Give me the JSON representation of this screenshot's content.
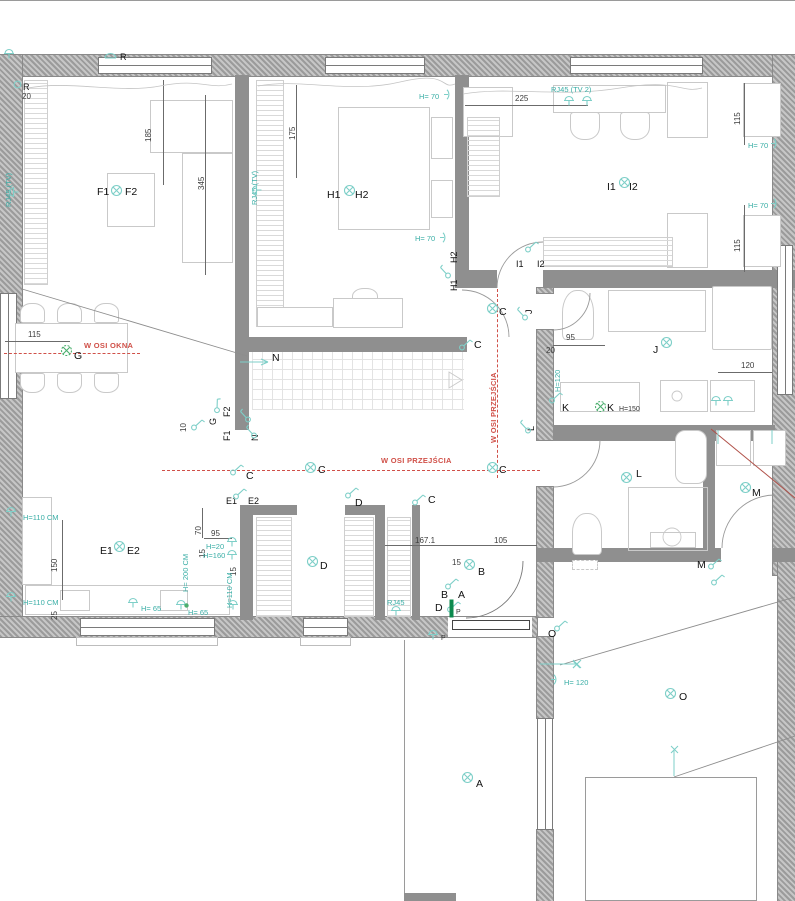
{
  "title": "Floor plan with electrical layout",
  "colors": {
    "teal_text": "#3aaea6",
    "teal_glyph": "#7ecfc8",
    "green": "#4caf6e",
    "red_axis": "#d05048",
    "dim_text": "#3d3d3d",
    "room_label": "#111111",
    "wall_gray": "#9b9b9b"
  },
  "axis_labels": [
    "W OSI OKNA",
    "W OSI PRZEJŚCIA",
    "W OSI PRZEJŚCIA"
  ],
  "texts": [
    {
      "t": "F1",
      "x": 97,
      "y": 186,
      "cls": "room"
    },
    {
      "t": "F2",
      "x": 125,
      "y": 186,
      "cls": "room"
    },
    {
      "t": "H1",
      "x": 327,
      "y": 189,
      "cls": "room"
    },
    {
      "t": "H2",
      "x": 355,
      "y": 189,
      "cls": "room"
    },
    {
      "t": "I1",
      "x": 607,
      "y": 181,
      "cls": "room"
    },
    {
      "t": "I2",
      "x": 629,
      "y": 181,
      "cls": "room"
    },
    {
      "t": "G",
      "x": 74,
      "y": 350,
      "cls": "room"
    },
    {
      "t": "N",
      "x": 272,
      "y": 352,
      "cls": "room"
    },
    {
      "t": "C",
      "x": 499,
      "y": 306,
      "cls": "room"
    },
    {
      "t": "C",
      "x": 474,
      "y": 339,
      "cls": "room"
    },
    {
      "t": "C",
      "x": 318,
      "y": 464,
      "cls": "room"
    },
    {
      "t": "C",
      "x": 499,
      "y": 464,
      "cls": "room"
    },
    {
      "t": "C",
      "x": 246,
      "y": 470,
      "cls": "room"
    },
    {
      "t": "C",
      "x": 428,
      "y": 494,
      "cls": "room"
    },
    {
      "t": "D",
      "x": 355,
      "y": 497,
      "cls": "room"
    },
    {
      "t": "D",
      "x": 320,
      "y": 560,
      "cls": "room"
    },
    {
      "t": "E1",
      "x": 226,
      "y": 496,
      "cls": "rm"
    },
    {
      "t": "E2",
      "x": 248,
      "y": 496,
      "cls": "rm"
    },
    {
      "t": "E1",
      "x": 100,
      "y": 545,
      "cls": "room"
    },
    {
      "t": "E2",
      "x": 127,
      "y": 545,
      "cls": "room"
    },
    {
      "t": "B",
      "x": 478,
      "y": 566,
      "cls": "room"
    },
    {
      "t": "B",
      "x": 441,
      "y": 589,
      "cls": "room"
    },
    {
      "t": "A",
      "x": 458,
      "y": 589,
      "cls": "room"
    },
    {
      "t": "D",
      "x": 435,
      "y": 602,
      "cls": "room"
    },
    {
      "t": "P",
      "x": 456,
      "y": 609,
      "cls": "tiny"
    },
    {
      "t": "P",
      "x": 441,
      "y": 635,
      "cls": "tiny"
    },
    {
      "t": "J",
      "x": 653,
      "y": 344,
      "cls": "room"
    },
    {
      "t": "K",
      "x": 562,
      "y": 402,
      "cls": "room"
    },
    {
      "t": "K",
      "x": 607,
      "y": 402,
      "cls": "room"
    },
    {
      "t": "H=150",
      "x": 619,
      "y": 406,
      "cls": "tiny"
    },
    {
      "t": "L",
      "x": 636,
      "y": 468,
      "cls": "room"
    },
    {
      "t": "M",
      "x": 752,
      "y": 487,
      "cls": "room"
    },
    {
      "t": "M",
      "x": 697,
      "y": 559,
      "cls": "room"
    },
    {
      "t": "O",
      "x": 679,
      "y": 691,
      "cls": "room"
    },
    {
      "t": "O",
      "x": 548,
      "y": 628,
      "cls": "room"
    },
    {
      "t": "A",
      "x": 476,
      "y": 778,
      "cls": "room"
    },
    {
      "t": "R",
      "x": 120,
      "y": 52,
      "cls": "rm"
    },
    {
      "t": "R",
      "x": 23,
      "y": 82,
      "cls": "rm"
    },
    {
      "t": "20",
      "x": 22,
      "y": 92,
      "cls": "dim"
    },
    {
      "t": "I1",
      "x": 516,
      "y": 259,
      "cls": "rm"
    },
    {
      "t": "I2",
      "x": 537,
      "y": 259,
      "cls": "rm"
    },
    {
      "t": "H2",
      "x": 449,
      "y": 263,
      "cls": "rm",
      "rot": -90
    },
    {
      "t": "H1",
      "x": 449,
      "y": 291,
      "cls": "rm",
      "rot": -90
    },
    {
      "t": "G",
      "x": 208,
      "y": 425,
      "cls": "rm",
      "rot": -90
    },
    {
      "t": "F2",
      "x": 222,
      "y": 417,
      "cls": "rm",
      "rot": -90
    },
    {
      "t": "F1",
      "x": 222,
      "y": 441,
      "cls": "rm",
      "rot": -90
    },
    {
      "t": "N",
      "x": 250,
      "y": 441,
      "cls": "rm",
      "rot": -90
    },
    {
      "t": "J",
      "x": 524,
      "y": 314,
      "cls": "rm",
      "rot": -90
    },
    {
      "t": "L",
      "x": 526,
      "y": 431,
      "cls": "rm",
      "rot": -90
    },
    {
      "t": "185",
      "x": 144,
      "y": 142,
      "cls": "dim",
      "rot": -90
    },
    {
      "t": "345",
      "x": 197,
      "y": 190,
      "cls": "dim",
      "rot": -90
    },
    {
      "t": "175",
      "x": 288,
      "y": 140,
      "cls": "dim",
      "rot": -90
    },
    {
      "t": "225",
      "x": 515,
      "y": 94,
      "cls": "dim"
    },
    {
      "t": "115",
      "x": 733,
      "y": 125,
      "cls": "dim",
      "rot": -90
    },
    {
      "t": "115",
      "x": 733,
      "y": 252,
      "cls": "dim",
      "rot": -90
    },
    {
      "t": "115",
      "x": 28,
      "y": 330,
      "cls": "dim"
    },
    {
      "t": "10",
      "x": 179,
      "y": 432,
      "cls": "dim",
      "rot": -90
    },
    {
      "t": "95",
      "x": 566,
      "y": 333,
      "cls": "dim"
    },
    {
      "t": "20",
      "x": 546,
      "y": 346,
      "cls": "dim"
    },
    {
      "t": "120",
      "x": 741,
      "y": 361,
      "cls": "dim"
    },
    {
      "t": "150",
      "x": 50,
      "y": 572,
      "cls": "dim",
      "rot": -90
    },
    {
      "t": "25",
      "x": 50,
      "y": 620,
      "cls": "dim",
      "rot": -90
    },
    {
      "t": "70",
      "x": 194,
      "y": 535,
      "cls": "dim",
      "rot": -90
    },
    {
      "t": "95",
      "x": 211,
      "y": 529,
      "cls": "dim"
    },
    {
      "t": "15",
      "x": 198,
      "y": 558,
      "cls": "dim",
      "rot": -90
    },
    {
      "t": "15",
      "x": 229,
      "y": 576,
      "cls": "dim",
      "rot": -90
    },
    {
      "t": "167.1",
      "x": 415,
      "y": 536,
      "cls": "dim"
    },
    {
      "t": "105",
      "x": 494,
      "y": 536,
      "cls": "dim"
    },
    {
      "t": "15",
      "x": 452,
      "y": 558,
      "cls": "dim"
    },
    {
      "t": "H= 70",
      "x": 419,
      "y": 92,
      "cls": "teal"
    },
    {
      "t": "H= 70",
      "x": 415,
      "y": 234,
      "cls": "teal"
    },
    {
      "t": "H= 70",
      "x": 748,
      "y": 141,
      "cls": "teal"
    },
    {
      "t": "H= 70",
      "x": 748,
      "y": 201,
      "cls": "teal"
    },
    {
      "t": "RJ45 (TV 2)",
      "x": 551,
      "y": 85,
      "cls": "teal"
    },
    {
      "t": "RJ45 (TV)",
      "x": 4,
      "y": 207,
      "cls": "teal",
      "rot": -90
    },
    {
      "t": "RJ45 (TV)",
      "x": 250,
      "y": 205,
      "cls": "teal",
      "rot": -90
    },
    {
      "t": "H=110 CM",
      "x": 23,
      "y": 513,
      "cls": "teal"
    },
    {
      "t": "H=110 CM",
      "x": 23,
      "y": 598,
      "cls": "teal"
    },
    {
      "t": "H= 65",
      "x": 141,
      "y": 604,
      "cls": "teal"
    },
    {
      "t": "H= 65",
      "x": 188,
      "y": 608,
      "cls": "teal"
    },
    {
      "t": "H= 200 CM",
      "x": 181,
      "y": 592,
      "cls": "teal",
      "rot": -90
    },
    {
      "t": "H=20",
      "x": 206,
      "y": 542,
      "cls": "teal"
    },
    {
      "t": "H=160",
      "x": 203,
      "y": 551,
      "cls": "teal"
    },
    {
      "t": "H=110 CM",
      "x": 225,
      "y": 608,
      "cls": "teal",
      "rot": -90
    },
    {
      "t": "H=120",
      "x": 553,
      "y": 392,
      "cls": "teal",
      "rot": -90
    },
    {
      "t": "H= 120",
      "x": 564,
      "y": 678,
      "cls": "teal"
    },
    {
      "t": "RJ45",
      "x": 387,
      "y": 598,
      "cls": "teal"
    },
    {
      "t": "W OSI OKNA",
      "x": 84,
      "y": 341,
      "cls": "red"
    },
    {
      "t": "W OSI PRZEJŚCIA",
      "x": 381,
      "y": 456,
      "cls": "red"
    },
    {
      "t": "W OSI PRZEJŚCIA",
      "x": 489,
      "y": 443,
      "cls": "red",
      "rot": -90
    }
  ],
  "symbols": [
    {
      "type": "light",
      "x": 110,
      "y": 184
    },
    {
      "type": "light",
      "x": 343,
      "y": 184
    },
    {
      "type": "light",
      "x": 618,
      "y": 176
    },
    {
      "type": "lightg",
      "x": 60,
      "y": 344
    },
    {
      "type": "light",
      "x": 486,
      "y": 302
    },
    {
      "type": "light",
      "x": 304,
      "y": 461
    },
    {
      "type": "light",
      "x": 486,
      "y": 461
    },
    {
      "type": "light",
      "x": 306,
      "y": 555
    },
    {
      "type": "light",
      "x": 113,
      "y": 540
    },
    {
      "type": "light",
      "x": 463,
      "y": 558
    },
    {
      "type": "light",
      "x": 660,
      "y": 336
    },
    {
      "type": "lightg",
      "x": 594,
      "y": 400
    },
    {
      "type": "light",
      "x": 620,
      "y": 471
    },
    {
      "type": "light",
      "x": 739,
      "y": 481
    },
    {
      "type": "light",
      "x": 664,
      "y": 687
    },
    {
      "type": "light",
      "x": 461,
      "y": 771
    },
    {
      "type": "blind",
      "x": 104,
      "y": 52
    },
    {
      "type": "circle",
      "x": 13,
      "y": 80
    },
    {
      "type": "socket",
      "x": 3,
      "y": 48
    },
    {
      "type": "switch",
      "x": 524,
      "y": 238
    },
    {
      "type": "switch",
      "x": 436,
      "y": 264,
      "rot": -90
    },
    {
      "type": "switch",
      "x": 190,
      "y": 416
    },
    {
      "type": "switch",
      "x": 209,
      "y": 397,
      "rot": -45
    },
    {
      "type": "switch",
      "x": 236,
      "y": 408,
      "rot": -90
    },
    {
      "type": "switch",
      "x": 242,
      "y": 424,
      "rot": -90
    },
    {
      "type": "switch",
      "x": 458,
      "y": 336
    },
    {
      "type": "switch",
      "x": 513,
      "y": 306,
      "rot": -90
    },
    {
      "type": "switch",
      "x": 516,
      "y": 419,
      "rot": -90
    },
    {
      "type": "switch",
      "x": 229,
      "y": 461
    },
    {
      "type": "switch",
      "x": 232,
      "y": 485
    },
    {
      "type": "switch",
      "x": 344,
      "y": 484
    },
    {
      "type": "switch",
      "x": 411,
      "y": 491
    },
    {
      "type": "switch",
      "x": 444,
      "y": 575
    },
    {
      "type": "switch",
      "x": 446,
      "y": 598
    },
    {
      "type": "socket",
      "x": 427,
      "y": 629
    },
    {
      "type": "switch",
      "x": 553,
      "y": 617
    },
    {
      "type": "switch",
      "x": 707,
      "y": 555
    },
    {
      "type": "switch",
      "x": 710,
      "y": 571
    },
    {
      "type": "switch",
      "x": 548,
      "y": 389
    },
    {
      "type": "socket",
      "x": 563,
      "y": 95
    },
    {
      "type": "socket",
      "x": 581,
      "y": 95
    },
    {
      "type": "socket",
      "x": 8,
      "y": 186,
      "rot": -90
    },
    {
      "type": "socket",
      "x": 251,
      "y": 184,
      "rot": -90
    },
    {
      "type": "bracket",
      "x": 444,
      "y": 89
    },
    {
      "type": "bracket",
      "x": 440,
      "y": 232
    },
    {
      "type": "bracket",
      "x": 771,
      "y": 138
    },
    {
      "type": "bracket",
      "x": 771,
      "y": 198
    },
    {
      "type": "socket",
      "x": 5,
      "y": 506
    },
    {
      "type": "socket",
      "x": 5,
      "y": 591
    },
    {
      "type": "socket",
      "x": 127,
      "y": 597
    },
    {
      "type": "socket",
      "x": 175,
      "y": 599
    },
    {
      "type": "dot",
      "x": 184,
      "y": 603
    },
    {
      "type": "socket",
      "x": 226,
      "y": 536
    },
    {
      "type": "socket",
      "x": 226,
      "y": 549
    },
    {
      "type": "socket",
      "x": 227,
      "y": 599
    },
    {
      "type": "socket",
      "x": 390,
      "y": 605
    },
    {
      "type": "socket",
      "x": 710,
      "y": 395
    },
    {
      "type": "socket",
      "x": 722,
      "y": 395
    },
    {
      "type": "bracket",
      "x": 551,
      "y": 674
    },
    {
      "type": "bar",
      "x": 449,
      "y": 599
    },
    {
      "type": "xmark",
      "x": 572,
      "y": 660
    },
    {
      "type": "xmark",
      "x": 670,
      "y": 745
    }
  ]
}
